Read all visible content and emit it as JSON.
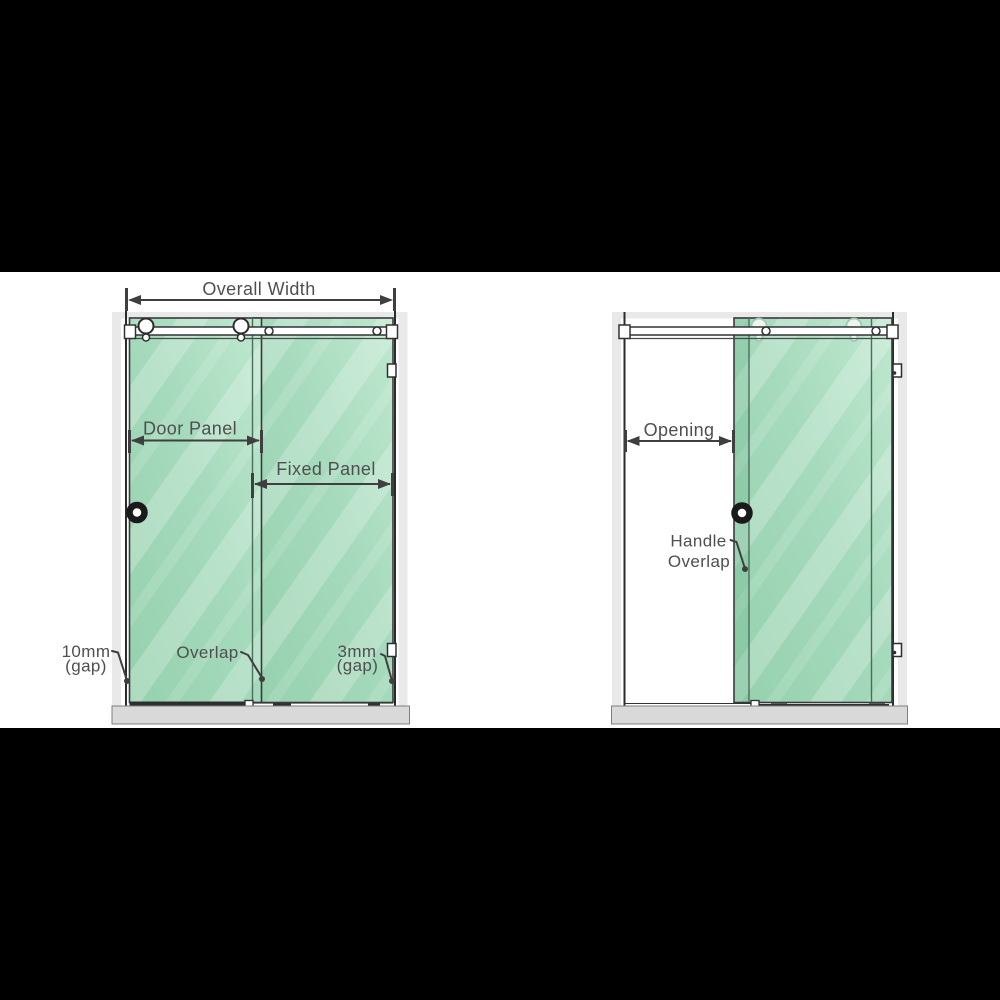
{
  "page": {
    "description": "Sliding shower screen dimension diagram, letterboxed product image",
    "background": "#ffffff",
    "letterbox_color": "#000000"
  },
  "colors": {
    "glass_green": "#a0d6b6",
    "glass_highlight": "#c4ead2",
    "outline_dark": "#3a3a3a",
    "dimension_text": "#4f4f4f",
    "wall_gray": "#e9e9e9",
    "tray_gray": "#d9d9d9"
  },
  "diagrams": {
    "closed_view": {
      "dimensions": {
        "overall_width": {
          "label": "Overall Width"
        },
        "door_panel": {
          "label": "Door Panel"
        },
        "fixed_panel": {
          "label": "Fixed Panel"
        }
      },
      "callouts": {
        "left_gap": {
          "line1": "10mm",
          "line2": "(gap)"
        },
        "overlap": {
          "label": "Overlap"
        },
        "right_gap": {
          "line1": "3mm",
          "line2": "(gap)"
        }
      }
    },
    "open_view": {
      "dimensions": {
        "opening": {
          "label": "Opening"
        }
      },
      "callouts": {
        "handle_overlap": {
          "line1": "Handle",
          "line2": "Overlap"
        }
      }
    }
  }
}
